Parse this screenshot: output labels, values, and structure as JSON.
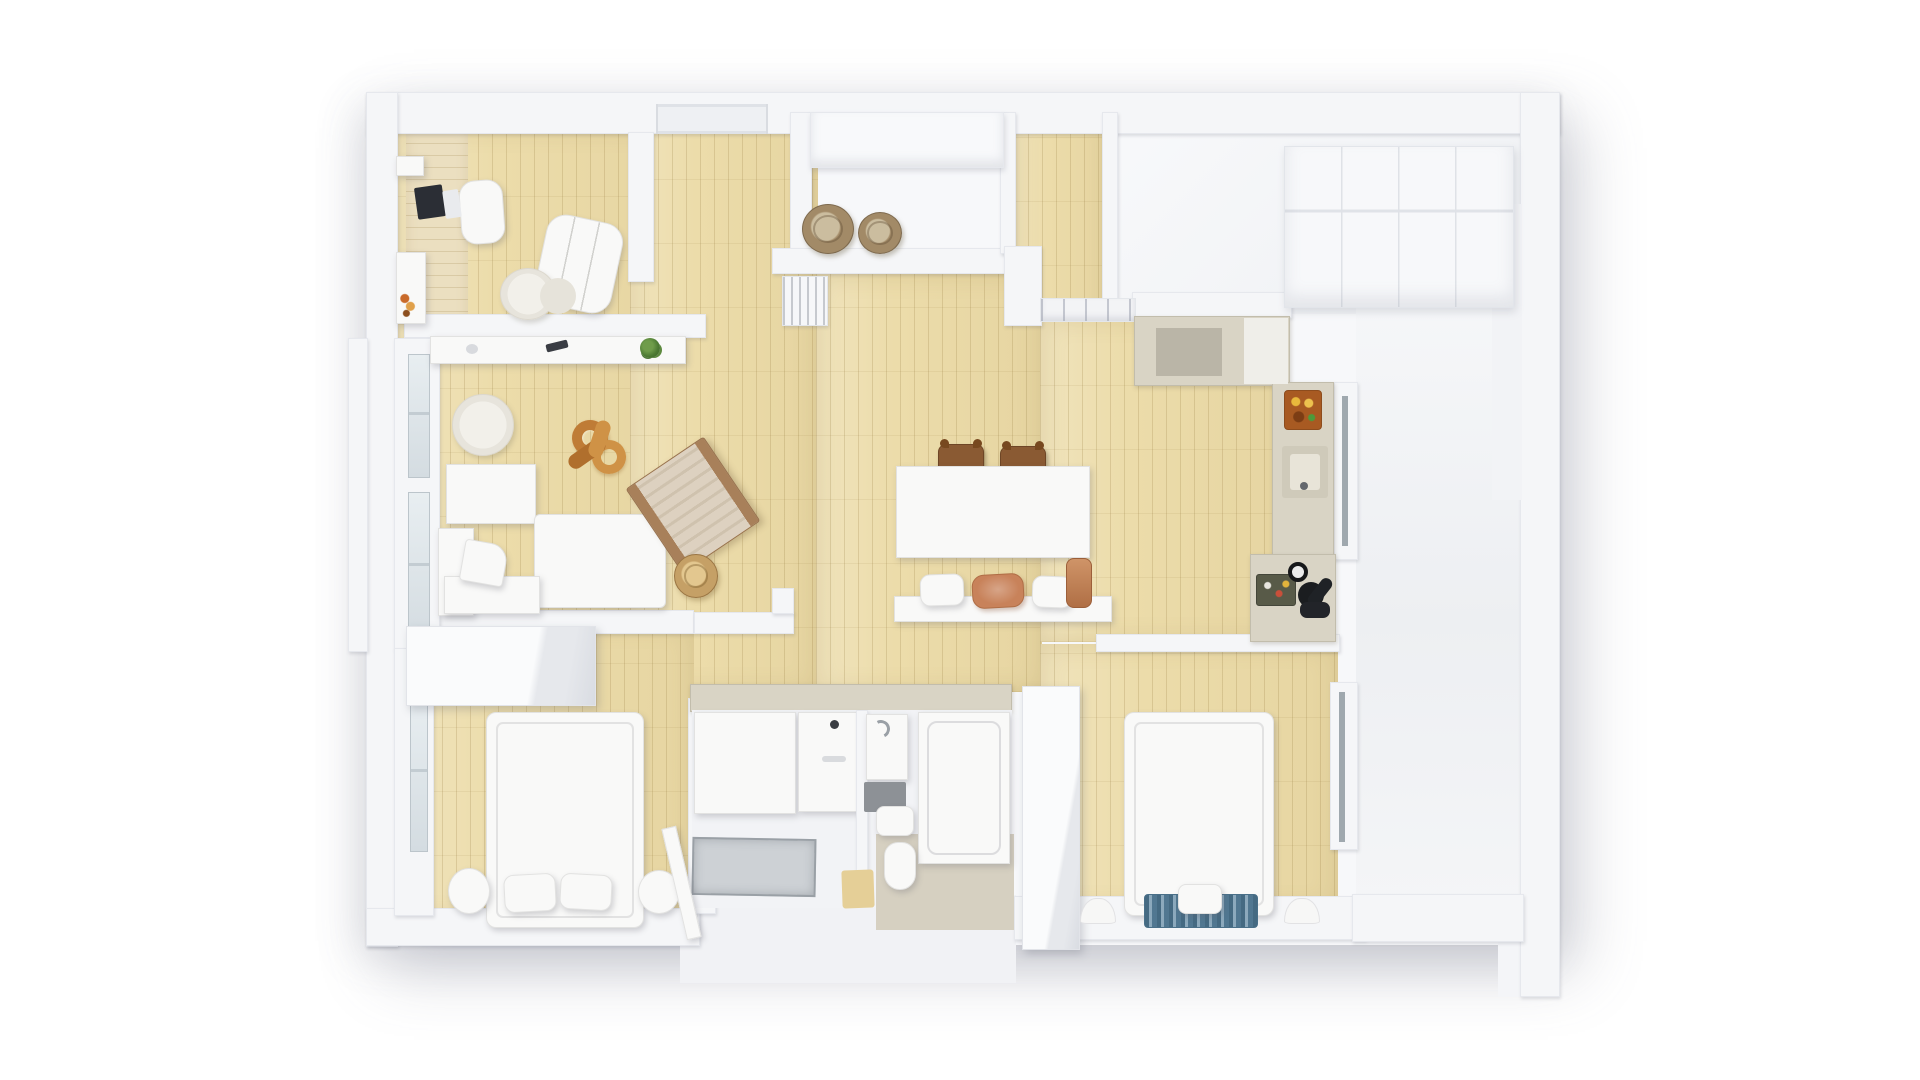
{
  "meta": {
    "description": "Top-down 3D render of an apartment floor plan: white walls, light oak plank floors, white furniture; office, living room, entry, wardrobe room, kitchen, dining area, bathroom, two bedrooms and a white side hall",
    "canvas": {
      "width": 1920,
      "height": 1080
    },
    "background": "#ffffff"
  },
  "palette": {
    "background": "#ffffff",
    "wall": "#f5f6f8",
    "wall_edge": "#e6e8ed",
    "wood_floor": "#ecdcaa",
    "wood_grain": "#927a3a",
    "furniture_white": "#f9f9f8",
    "counter_beige": "#d9d4c5",
    "terracotta": "#c8825a",
    "wood_brown": "#8a5a33",
    "sculpture_orange": "#bf7c36",
    "blanket_blue": "#5f88a3",
    "glass": "#d4dce1",
    "appliance_dark": "#1b1d20"
  },
  "rooms": [
    "office",
    "living-room",
    "entry",
    "wardrobe-room",
    "hallway",
    "kitchen",
    "dining-area",
    "bathroom",
    "bedroom-1",
    "bedroom-2",
    "side-hall"
  ],
  "shapes": [
    {
      "n": "building-base",
      "x": 366,
      "y": 92,
      "w": 1194,
      "h": 853,
      "cls": "base",
      "z": 1
    },
    {
      "n": "building-extension-bathroom",
      "x": 680,
      "y": 895,
      "w": 336,
      "h": 88,
      "c": "#f1f2f5",
      "z": 1
    },
    {
      "n": "building-extension-right",
      "x": 1498,
      "y": 900,
      "w": 62,
      "h": 97,
      "c": "#f4f5f8",
      "z": 1
    },
    {
      "n": "floor-office",
      "x": 394,
      "y": 128,
      "w": 294,
      "h": 517,
      "cls": "wood",
      "z": 2
    },
    {
      "n": "floor-entry",
      "x": 630,
      "y": 112,
      "w": 188,
      "h": 580,
      "cls": "wood",
      "z": 2
    },
    {
      "n": "floor-corridor",
      "x": 1014,
      "y": 112,
      "w": 94,
      "h": 218,
      "cls": "wood",
      "z": 2
    },
    {
      "n": "floor-hall",
      "x": 816,
      "y": 274,
      "w": 226,
      "h": 418,
      "cls": "wood",
      "z": 2
    },
    {
      "n": "floor-kitchen",
      "x": 1040,
      "y": 318,
      "w": 248,
      "h": 324,
      "cls": "wood",
      "z": 2
    },
    {
      "n": "floor-bedroom-1",
      "x": 400,
      "y": 624,
      "w": 294,
      "h": 296,
      "cls": "wood",
      "z": 2
    },
    {
      "n": "floor-bedroom-2",
      "x": 1040,
      "y": 644,
      "w": 298,
      "h": 266,
      "cls": "wood",
      "z": 2
    },
    {
      "n": "floor-wardrobe-room",
      "x": 1108,
      "y": 112,
      "w": 414,
      "h": 202,
      "cls": "floorwhite",
      "z": 2
    },
    {
      "n": "floor-side-hall",
      "x": 1356,
      "y": 278,
      "w": 166,
      "h": 624,
      "cls": "floorwhite2",
      "z": 2
    },
    {
      "n": "desk-top-office",
      "x": 406,
      "y": 132,
      "w": 62,
      "h": 192,
      "cls": "woodh",
      "z": 3
    },
    {
      "n": "wall-top",
      "x": 366,
      "y": 92,
      "w": 1194,
      "h": 42,
      "cls": "wall",
      "z": 3
    },
    {
      "n": "wall-left",
      "x": 366,
      "y": 92,
      "w": 32,
      "h": 855,
      "cls": "wall",
      "z": 3
    },
    {
      "n": "wall-right-outer",
      "x": 1520,
      "y": 92,
      "w": 40,
      "h": 905,
      "cls": "wall",
      "z": 3
    },
    {
      "n": "wall-bottom-left",
      "x": 366,
      "y": 908,
      "w": 334,
      "h": 38,
      "cls": "wall",
      "z": 3
    },
    {
      "n": "wall-bottom-right",
      "x": 1014,
      "y": 896,
      "w": 352,
      "h": 44,
      "cls": "wall",
      "z": 3
    },
    {
      "n": "wall-bottom-side-hall",
      "x": 1352,
      "y": 894,
      "w": 172,
      "h": 48,
      "cls": "wall",
      "z": 3
    },
    {
      "n": "entry-door-frame",
      "x": 656,
      "y": 104,
      "w": 112,
      "h": 30,
      "cls": "doorframe",
      "z": 4
    },
    {
      "n": "wall-office-right",
      "x": 628,
      "y": 132,
      "w": 26,
      "h": 150,
      "cls": "wall",
      "z": 3
    },
    {
      "n": "wall-office-divider",
      "x": 404,
      "y": 314,
      "w": 302,
      "h": 24,
      "cls": "wall",
      "z": 3
    },
    {
      "n": "wall-living-bottom",
      "x": 436,
      "y": 610,
      "w": 258,
      "h": 24,
      "cls": "wall",
      "z": 3
    },
    {
      "n": "wall-bath-top",
      "x": 694,
      "y": 612,
      "w": 100,
      "h": 22,
      "cls": "wall",
      "z": 3
    },
    {
      "n": "wall-bath-step",
      "x": 772,
      "y": 588,
      "w": 22,
      "h": 26,
      "cls": "wall",
      "z": 3
    },
    {
      "n": "wall-entry-left",
      "x": 790,
      "y": 112,
      "w": 22,
      "h": 150,
      "cls": "wall",
      "z": 3
    },
    {
      "n": "entry-closet",
      "x": 810,
      "y": 112,
      "w": 194,
      "h": 56,
      "cls": "closetfront",
      "z": 4
    },
    {
      "n": "wall-entry-bottom",
      "x": 772,
      "y": 248,
      "w": 246,
      "h": 26,
      "cls": "wall",
      "z": 3
    },
    {
      "n": "wall-corridor-left-upper",
      "x": 1000,
      "y": 112,
      "w": 16,
      "h": 142,
      "cls": "wall",
      "z": 3
    },
    {
      "n": "wall-corridor-left-lower",
      "x": 1004,
      "y": 246,
      "w": 38,
      "h": 80,
      "cls": "wall",
      "z": 3
    },
    {
      "n": "hall-shelf-band",
      "x": 1040,
      "y": 298,
      "w": 96,
      "h": 24,
      "cls": "shelfband",
      "z": 4
    },
    {
      "n": "wall-wardrobe-room-left",
      "x": 1102,
      "y": 112,
      "w": 16,
      "h": 190,
      "cls": "wall",
      "z": 3
    },
    {
      "n": "wall-kitchen-top",
      "x": 1132,
      "y": 292,
      "w": 160,
      "h": 26,
      "cls": "wall",
      "z": 3
    },
    {
      "n": "closet-row-wardrobe-room",
      "x": 1284,
      "y": 146,
      "w": 230,
      "h": 162,
      "cls": "closets",
      "z": 4
    },
    {
      "n": "wall-inner-right",
      "x": 1492,
      "y": 204,
      "w": 30,
      "h": 296,
      "c": "#f2f3f6",
      "z": 3
    },
    {
      "n": "window-sill-left",
      "x": 348,
      "y": 338,
      "w": 20,
      "h": 314,
      "cls": "wall",
      "z": 3
    },
    {
      "n": "wall-living-window",
      "x": 394,
      "y": 338,
      "w": 46,
      "h": 312,
      "cls": "wall",
      "z": 3
    },
    {
      "n": "window-glass-living-1",
      "x": 408,
      "y": 354,
      "w": 22,
      "h": 124,
      "cls": "glass",
      "z": 4
    },
    {
      "n": "window-glass-living-2",
      "x": 408,
      "y": 492,
      "w": 22,
      "h": 150,
      "cls": "glass",
      "z": 4
    },
    {
      "n": "wall-bedroom1-window",
      "x": 394,
      "y": 648,
      "w": 40,
      "h": 268,
      "cls": "wall",
      "z": 3
    },
    {
      "n": "window-glass-bedroom-1",
      "x": 410,
      "y": 696,
      "w": 18,
      "h": 156,
      "cls": "glass",
      "z": 4
    },
    {
      "n": "wall-bedroom1-right",
      "x": 688,
      "y": 698,
      "w": 28,
      "h": 216,
      "cls": "wall",
      "z": 3
    },
    {
      "n": "wall-bedroom2-top",
      "x": 1096,
      "y": 634,
      "w": 244,
      "h": 18,
      "cls": "wall",
      "z": 3
    },
    {
      "n": "wall-bedroom2-right",
      "x": 1330,
      "y": 682,
      "w": 28,
      "h": 168,
      "cls": "wall",
      "z": 3
    },
    {
      "n": "glass-door-bedroom-2",
      "x": 1339,
      "y": 692,
      "w": 6,
      "h": 150,
      "c": "#9fa8ae",
      "z": 5
    },
    {
      "n": "wall-kitchen-door",
      "x": 1334,
      "y": 382,
      "w": 24,
      "h": 178,
      "cls": "wall",
      "z": 3
    },
    {
      "n": "glass-door-kitchen",
      "x": 1342,
      "y": 396,
      "w": 6,
      "h": 150,
      "c": "#9fa8ae",
      "z": 5
    },
    {
      "n": "kitchen-upper-unit",
      "x": 1134,
      "y": 316,
      "w": 156,
      "h": 70,
      "cls": "counter",
      "z": 4
    },
    {
      "n": "kitchen-upper-notch",
      "x": 1156,
      "y": 328,
      "w": 66,
      "h": 48,
      "c": "#bab5a7",
      "z": 5
    },
    {
      "n": "kitchen-upper-white-top",
      "x": 1244,
      "y": 318,
      "w": 44,
      "h": 66,
      "c": "#efeee9",
      "z": 5
    },
    {
      "n": "kitchen-counter-right",
      "x": 1272,
      "y": 382,
      "w": 62,
      "h": 178,
      "cls": "counter",
      "z": 4
    },
    {
      "n": "stove-cooktop",
      "x": 1284,
      "y": 390,
      "w": 38,
      "h": 40,
      "cls": "stove",
      "z": 5
    },
    {
      "n": "kitchen-sink",
      "x": 1282,
      "y": 446,
      "w": 46,
      "h": 52,
      "c": "#cfcaba",
      "r": 3,
      "z": 5
    },
    {
      "n": "kitchen-sink-basin",
      "x": 1290,
      "y": 454,
      "w": 30,
      "h": 36,
      "c": "#e8e4d8",
      "r": 3,
      "z": 6
    },
    {
      "n": "kitchen-faucet-dot",
      "x": 1300,
      "y": 482,
      "w": 8,
      "h": 8,
      "c": "#64686d",
      "r": "50%",
      "z": 7
    },
    {
      "n": "kitchen-counter-lower",
      "x": 1250,
      "y": 554,
      "w": 86,
      "h": 88,
      "cls": "counter",
      "z": 4
    },
    {
      "n": "kitchen-tray-dishes",
      "x": 1256,
      "y": 574,
      "w": 40,
      "h": 32,
      "cls": "tray",
      "z": 5
    },
    {
      "n": "kitchen-scale-gauge",
      "x": 1288,
      "y": 562,
      "w": 20,
      "h": 20,
      "cls": "gauge",
      "z": 5
    },
    {
      "n": "kettle-black",
      "x": 1298,
      "y": 582,
      "w": 26,
      "h": 26,
      "c": "#1b1d20",
      "r": "50%",
      "z": 5
    },
    {
      "n": "bottle-black",
      "x": 1314,
      "y": 576,
      "w": 12,
      "h": 32,
      "c": "#1f2226",
      "r": 6,
      "rot": 38,
      "z": 5
    },
    {
      "n": "pot-black",
      "x": 1300,
      "y": 602,
      "w": 30,
      "h": 16,
      "c": "#222429",
      "r": 7,
      "z": 5
    },
    {
      "n": "basket-entry-1",
      "x": 802,
      "y": 204,
      "w": 52,
      "h": 50,
      "cls": "basket",
      "z": 4
    },
    {
      "n": "basket-entry-2",
      "x": 858,
      "y": 212,
      "w": 44,
      "h": 42,
      "cls": "basket",
      "z": 4
    },
    {
      "n": "radiator-hall",
      "x": 782,
      "y": 276,
      "w": 46,
      "h": 50,
      "cls": "radiator",
      "z": 4
    },
    {
      "n": "laptop",
      "x": 416,
      "y": 186,
      "w": 28,
      "h": 32,
      "c": "#2b2e35",
      "r": 2,
      "rot": -8,
      "z": 5
    },
    {
      "n": "notepad",
      "x": 444,
      "y": 190,
      "w": 16,
      "h": 28,
      "c": "#e9ebee",
      "r": 2,
      "rot": -8,
      "z": 5
    },
    {
      "n": "office-chair",
      "x": 460,
      "y": 180,
      "w": 44,
      "h": 64,
      "cls": "furn",
      "r": 16,
      "rot": -4,
      "z": 4
    },
    {
      "n": "wall-shelf-office-1",
      "x": 396,
      "y": 156,
      "w": 28,
      "h": 20,
      "cls": "furn",
      "z": 4
    },
    {
      "n": "wall-shelf-office-2",
      "x": 396,
      "y": 252,
      "w": 30,
      "h": 72,
      "cls": "furn",
      "z": 4
    },
    {
      "n": "shelf-bottles",
      "x": 400,
      "y": 292,
      "w": 16,
      "h": 26,
      "cls": "bottles",
      "z": 5
    },
    {
      "n": "armchair-office",
      "x": 540,
      "y": 218,
      "w": 78,
      "h": 92,
      "cls": "furn cushions",
      "r": 20,
      "rot": 12,
      "z": 4
    },
    {
      "n": "rug-office",
      "x": 500,
      "y": 268,
      "w": 56,
      "h": 52,
      "cls": "rug",
      "z": 4
    },
    {
      "n": "pouf-office",
      "x": 540,
      "y": 278,
      "w": 36,
      "h": 36,
      "c": "#e6e3da",
      "r": "50%",
      "z": 5
    },
    {
      "n": "console-sideboard",
      "x": 430,
      "y": 336,
      "w": 256,
      "h": 28,
      "cls": "furn",
      "z": 4
    },
    {
      "n": "console-sensor",
      "x": 466,
      "y": 344,
      "w": 12,
      "h": 10,
      "c": "#d8dade",
      "r": "50%",
      "z": 5
    },
    {
      "n": "remote-control",
      "x": 546,
      "y": 342,
      "w": 22,
      "h": 8,
      "c": "#3a3d44",
      "r": 2,
      "rot": -14,
      "z": 5
    },
    {
      "n": "potted-plant",
      "x": 640,
      "y": 338,
      "w": 20,
      "h": 20,
      "cls": "plant",
      "z": 5
    },
    {
      "n": "rug-living",
      "x": 452,
      "y": 394,
      "w": 62,
      "h": 62,
      "cls": "rug",
      "z": 4
    },
    {
      "n": "chain-sculpture-ring-1",
      "x": 572,
      "y": 420,
      "w": 36,
      "h": 36,
      "cls": "ring",
      "rot": -15,
      "z": 4
    },
    {
      "n": "chain-sculpture-ring-2",
      "x": 592,
      "y": 440,
      "w": 34,
      "h": 34,
      "cls": "ring2",
      "rot": 20,
      "z": 4
    },
    {
      "n": "chain-sculpture-link-1",
      "x": 566,
      "y": 446,
      "w": 42,
      "h": 15,
      "c": "#b06f2d",
      "r": 8,
      "rot": -35,
      "z": 5
    },
    {
      "n": "chain-sculpture-link-2",
      "x": 592,
      "y": 420,
      "w": 15,
      "h": 38,
      "c": "#cf9246",
      "r": 8,
      "rot": 18,
      "z": 5
    },
    {
      "n": "sofa-back",
      "x": 446,
      "y": 464,
      "w": 90,
      "h": 60,
      "cls": "furn",
      "z": 4
    },
    {
      "n": "sofa-chaise",
      "x": 534,
      "y": 514,
      "w": 132,
      "h": 94,
      "cls": "furn",
      "r": 6,
      "z": 4
    },
    {
      "n": "sofa-armrest",
      "x": 438,
      "y": 528,
      "w": 36,
      "h": 88,
      "cls": "furn",
      "z": 4
    },
    {
      "n": "sofa-seat",
      "x": 444,
      "y": 576,
      "w": 96,
      "h": 38,
      "cls": "furn",
      "z": 4
    },
    {
      "n": "sofa-pillow",
      "x": 462,
      "y": 542,
      "w": 44,
      "h": 42,
      "cls": "furn",
      "r": "4px 18px 4px 4px",
      "rot": 10,
      "z": 5
    },
    {
      "n": "lounge-chair-wood",
      "x": 646,
      "y": 454,
      "w": 94,
      "h": 102,
      "cls": "loungechair",
      "rot": -34,
      "z": 4
    },
    {
      "n": "basket-living",
      "x": 674,
      "y": 554,
      "w": 44,
      "h": 44,
      "cls": "basket2",
      "z": 4
    },
    {
      "n": "dining-chair-1",
      "x": 938,
      "y": 444,
      "w": 46,
      "h": 32,
      "cls": "chair",
      "z": 4
    },
    {
      "n": "dining-chair-2",
      "x": 1000,
      "y": 446,
      "w": 46,
      "h": 32,
      "cls": "chair",
      "z": 4
    },
    {
      "n": "dining-table",
      "x": 896,
      "y": 466,
      "w": 194,
      "h": 92,
      "cls": "furn",
      "z": 4
    },
    {
      "n": "dining-bench",
      "x": 894,
      "y": 596,
      "w": 218,
      "h": 26,
      "cls": "furn",
      "z": 4
    },
    {
      "n": "bench-cushion-1",
      "x": 920,
      "y": 574,
      "w": 44,
      "h": 32,
      "cls": "furn",
      "r": 10,
      "rot": -2,
      "z": 5
    },
    {
      "n": "bench-cushion-terracotta",
      "x": 972,
      "y": 574,
      "w": 52,
      "h": 34,
      "cls": "terracushion",
      "rot": -3,
      "z": 5
    },
    {
      "n": "bench-cushion-2",
      "x": 1032,
      "y": 576,
      "w": 40,
      "h": 32,
      "cls": "furn",
      "r": 10,
      "rot": 2,
      "z": 5
    },
    {
      "n": "terracotta-pot",
      "x": 1066,
      "y": 558,
      "w": 26,
      "h": 50,
      "cls": "terrapot",
      "z": 5
    },
    {
      "n": "bathroom-top-counter",
      "x": 690,
      "y": 684,
      "w": 322,
      "h": 28,
      "cls": "counter",
      "z": 4
    },
    {
      "n": "bathroom-floor",
      "x": 692,
      "y": 710,
      "w": 320,
      "h": 198,
      "c": "#f2f3f6",
      "z": 4
    },
    {
      "n": "shower-stall",
      "x": 694,
      "y": 712,
      "w": 102,
      "h": 102,
      "cls": "furn",
      "z": 5
    },
    {
      "n": "vanity-cabinet",
      "x": 798,
      "y": 712,
      "w": 60,
      "h": 100,
      "cls": "furn",
      "z": 5
    },
    {
      "n": "vanity-faucet-dot",
      "x": 830,
      "y": 720,
      "w": 9,
      "h": 9,
      "c": "#3b3e43",
      "r": "50%",
      "z": 6
    },
    {
      "n": "vanity-handle",
      "x": 822,
      "y": 756,
      "w": 24,
      "h": 6,
      "c": "#d9dbde",
      "r": 3,
      "z": 6
    },
    {
      "n": "bathroom-divider",
      "x": 856,
      "y": 710,
      "w": 12,
      "h": 162,
      "cls": "wall",
      "z": 5
    },
    {
      "n": "washbasin-unit",
      "x": 866,
      "y": 714,
      "w": 42,
      "h": 66,
      "cls": "furn",
      "z": 5
    },
    {
      "n": "washbasin-faucet",
      "x": 872,
      "y": 720,
      "w": 18,
      "h": 18,
      "cls": "faucet",
      "z": 6
    },
    {
      "n": "bath-mat-dark",
      "x": 864,
      "y": 782,
      "w": 42,
      "h": 30,
      "c": "#8d9196",
      "r": 2,
      "z": 5
    },
    {
      "n": "toilet-tank",
      "x": 876,
      "y": 806,
      "w": 38,
      "h": 30,
      "cls": "furn",
      "r": 8,
      "z": 5
    },
    {
      "n": "bathtub",
      "x": 918,
      "y": 712,
      "w": 92,
      "h": 152,
      "cls": "furn tub",
      "z": 5
    },
    {
      "n": "shower-tray",
      "x": 692,
      "y": 838,
      "w": 124,
      "h": 58,
      "cls": "shtray",
      "rot": 1,
      "z": 5
    },
    {
      "n": "shower-wood-mat",
      "x": 842,
      "y": 870,
      "w": 32,
      "h": 38,
      "c": "#e5cf97",
      "r": 3,
      "rot": -2,
      "z": 5
    },
    {
      "n": "wc-compartment",
      "x": 876,
      "y": 834,
      "w": 138,
      "h": 96,
      "c": "#d6d0c1",
      "z": 4
    },
    {
      "n": "toilet-bowl",
      "x": 884,
      "y": 842,
      "w": 32,
      "h": 48,
      "cls": "furn",
      "r": "14px 14px 16px 16px",
      "z": 5
    },
    {
      "n": "door-bedroom-1",
      "x": 674,
      "y": 826,
      "w": 15,
      "h": 114,
      "cls": "furn",
      "rot": -13,
      "z": 6
    },
    {
      "n": "wardrobe-bedroom-1",
      "x": 406,
      "y": 626,
      "w": 190,
      "h": 80,
      "cls": "box3d",
      "z": 4
    },
    {
      "n": "bed-bedroom-1",
      "x": 486,
      "y": 712,
      "w": 158,
      "h": 216,
      "cls": "furn bed",
      "r": 10,
      "z": 4
    },
    {
      "n": "pillow-bed1-left",
      "x": 504,
      "y": 874,
      "w": 52,
      "h": 38,
      "cls": "furn",
      "r": 10,
      "rot": -3,
      "z": 5
    },
    {
      "n": "pillow-bed1-right",
      "x": 560,
      "y": 874,
      "w": 52,
      "h": 36,
      "cls": "furn",
      "r": 10,
      "rot": 3,
      "z": 5
    },
    {
      "n": "bolster-bed1-left",
      "x": 448,
      "y": 868,
      "w": 42,
      "h": 46,
      "cls": "furn",
      "r": "50%",
      "z": 5
    },
    {
      "n": "bolster-bed1-right",
      "x": 638,
      "y": 870,
      "w": 42,
      "h": 44,
      "cls": "furn",
      "r": "50%",
      "z": 5
    },
    {
      "n": "wardrobe-bedroom-2",
      "x": 1022,
      "y": 686,
      "w": 58,
      "h": 264,
      "cls": "box3d",
      "z": 4
    },
    {
      "n": "bed-bedroom-2",
      "x": 1124,
      "y": 712,
      "w": 150,
      "h": 204,
      "cls": "furn bed",
      "r": 10,
      "z": 4
    },
    {
      "n": "blanket-blue",
      "x": 1144,
      "y": 894,
      "w": 114,
      "h": 34,
      "cls": "blanket",
      "z": 5
    },
    {
      "n": "pillow-bed2",
      "x": 1178,
      "y": 884,
      "w": 44,
      "h": 30,
      "cls": "furn",
      "r": 8,
      "z": 6
    },
    {
      "n": "wall-bump-left",
      "x": 1080,
      "y": 898,
      "w": 36,
      "h": 26,
      "cls": "halfmoon",
      "z": 5
    },
    {
      "n": "wall-bump-right",
      "x": 1284,
      "y": 898,
      "w": 36,
      "h": 26,
      "cls": "halfmoon",
      "z": 5
    }
  ]
}
